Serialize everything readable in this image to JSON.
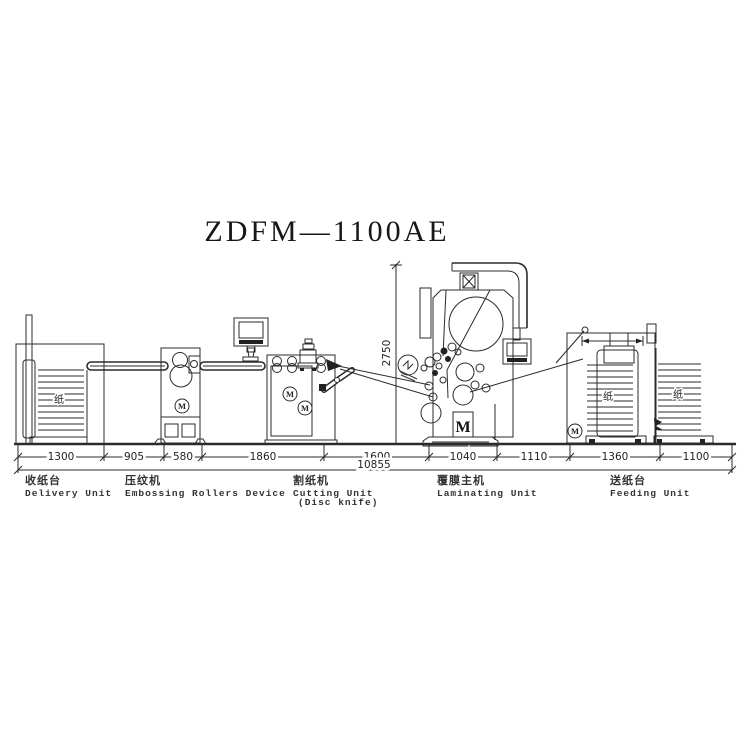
{
  "title": "ZDFM—1100AE",
  "dims": {
    "segments": [
      "1300",
      "905",
      "580",
      "1860",
      "1600",
      "1040",
      "1110",
      "1360",
      "1100"
    ],
    "total": "10855",
    "height": "2750"
  },
  "units": [
    {
      "zh": "收纸台",
      "en": "Delivery Unit"
    },
    {
      "zh": "压纹机",
      "en": "Embossing Rollers Device"
    },
    {
      "zh": "割纸机",
      "en": "Cutting Unit",
      "en2": "(Disc knife)"
    },
    {
      "zh": "覆膜主机",
      "en": "Laminating Unit"
    },
    {
      "zh": "送纸台",
      "en": "Feeding Unit"
    }
  ],
  "marks": {
    "paper": "纸",
    "motor": "M"
  },
  "colors": {
    "line": "#2b2b2b",
    "background": "#ffffff"
  }
}
